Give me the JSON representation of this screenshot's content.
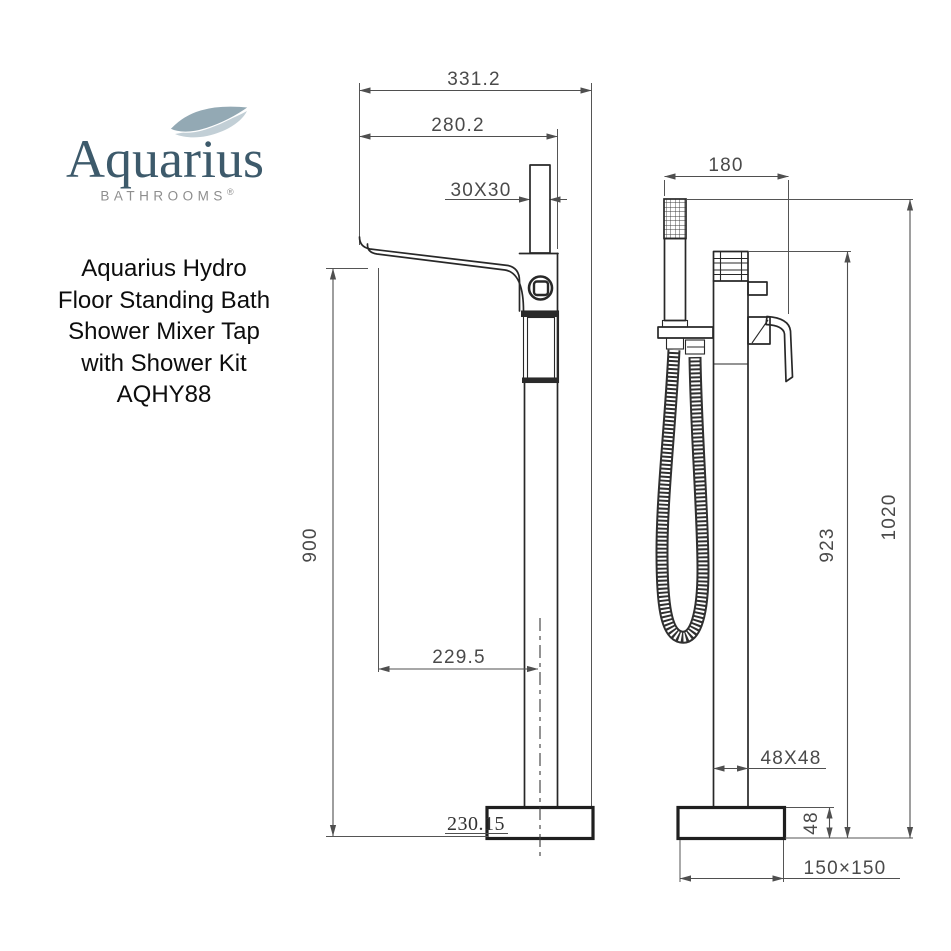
{
  "logo": {
    "brand": "Aquarius",
    "subtitle": "BATHROOMS",
    "registered": "®"
  },
  "product": {
    "title_lines": [
      "Aquarius Hydro",
      "Floor Standing Bath",
      "Shower Mixer Tap",
      "with Shower Kit",
      "AQHY88"
    ]
  },
  "front_view": {
    "overall_width": "331.2",
    "spout_width": "280.2",
    "holder_size": "30X30",
    "height": "900",
    "spout_reach": "229.5",
    "base_note": "230.15"
  },
  "side_view": {
    "depth": "180",
    "column_height": "923",
    "overall_height": "1020",
    "column_size": "48X48",
    "base_height": "48",
    "base_plate": "150×150"
  },
  "colors": {
    "brand_blue": "#3d5a6b",
    "brand_gray": "#8e8e8e",
    "wave_dark": "#93a9b4",
    "wave_light": "#c2cfd6",
    "line": "#282828",
    "dimension": "#4a4a4a"
  }
}
